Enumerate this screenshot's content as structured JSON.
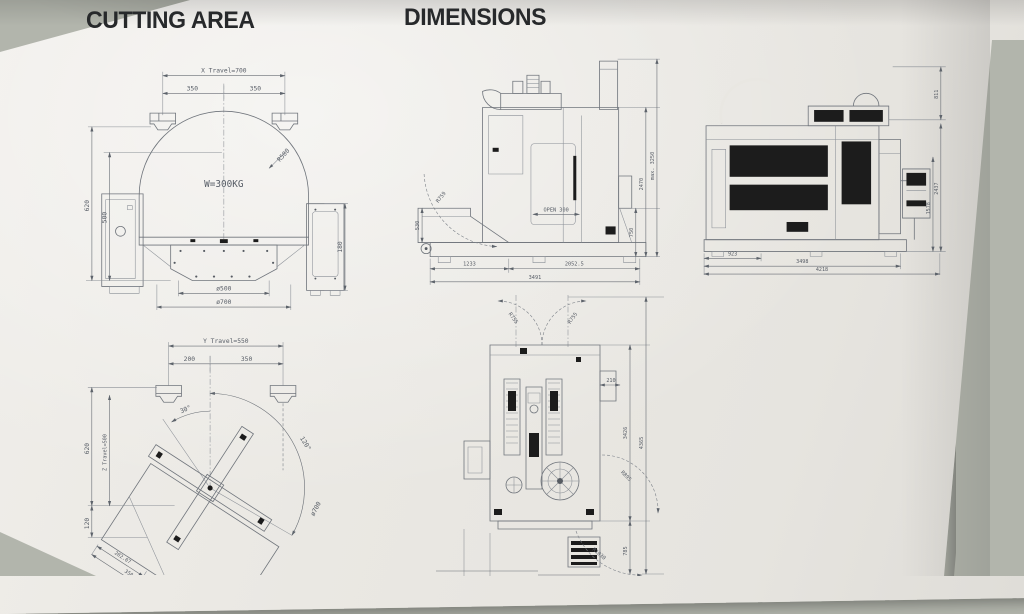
{
  "titles": {
    "cutting_area": "CUTTING AREA",
    "dimensions": "DIMENSIONS"
  },
  "cutting_top_view": {
    "x_travel": "X Travel=700",
    "left_350": "350",
    "right_350": "350",
    "radius_500": "R500",
    "weight": "W=300KG",
    "height_620": "620",
    "height_500": "500",
    "height_180": "180",
    "dia_500": "ø500",
    "dia_700": "ø700"
  },
  "cutting_front_view": {
    "y_travel": "Y Travel=550",
    "left_200": "200",
    "right_350": "350",
    "angle_30": "30°",
    "angle_120": "120°",
    "height_620": "620",
    "z_travel": "Z Travel=500",
    "height_120": "120",
    "len_202": "202.07",
    "len_350": "350",
    "dia_700": "ø700"
  },
  "dim_front_view": {
    "radius_759": "R759",
    "height_530": "530",
    "open_label": "OPEN 300",
    "width_1233": "1233",
    "width_2052": "2052.5",
    "width_3491": "3491",
    "height_max": "max. 3250",
    "height_2470": "2470",
    "height_750": "750"
  },
  "dim_side_view": {
    "height_811": "811",
    "height_2437": "2437",
    "height_1578": "1578",
    "width_923": "923",
    "width_3498": "3498",
    "width_4218": "4218"
  },
  "dim_plan_view": {
    "radius_left": "R755",
    "radius_right": "R755",
    "width_210": "210",
    "height_3426": "3426",
    "height_4365": "4365",
    "radius_895": "R895",
    "radius_1030": "R1030",
    "height_785": "785"
  }
}
